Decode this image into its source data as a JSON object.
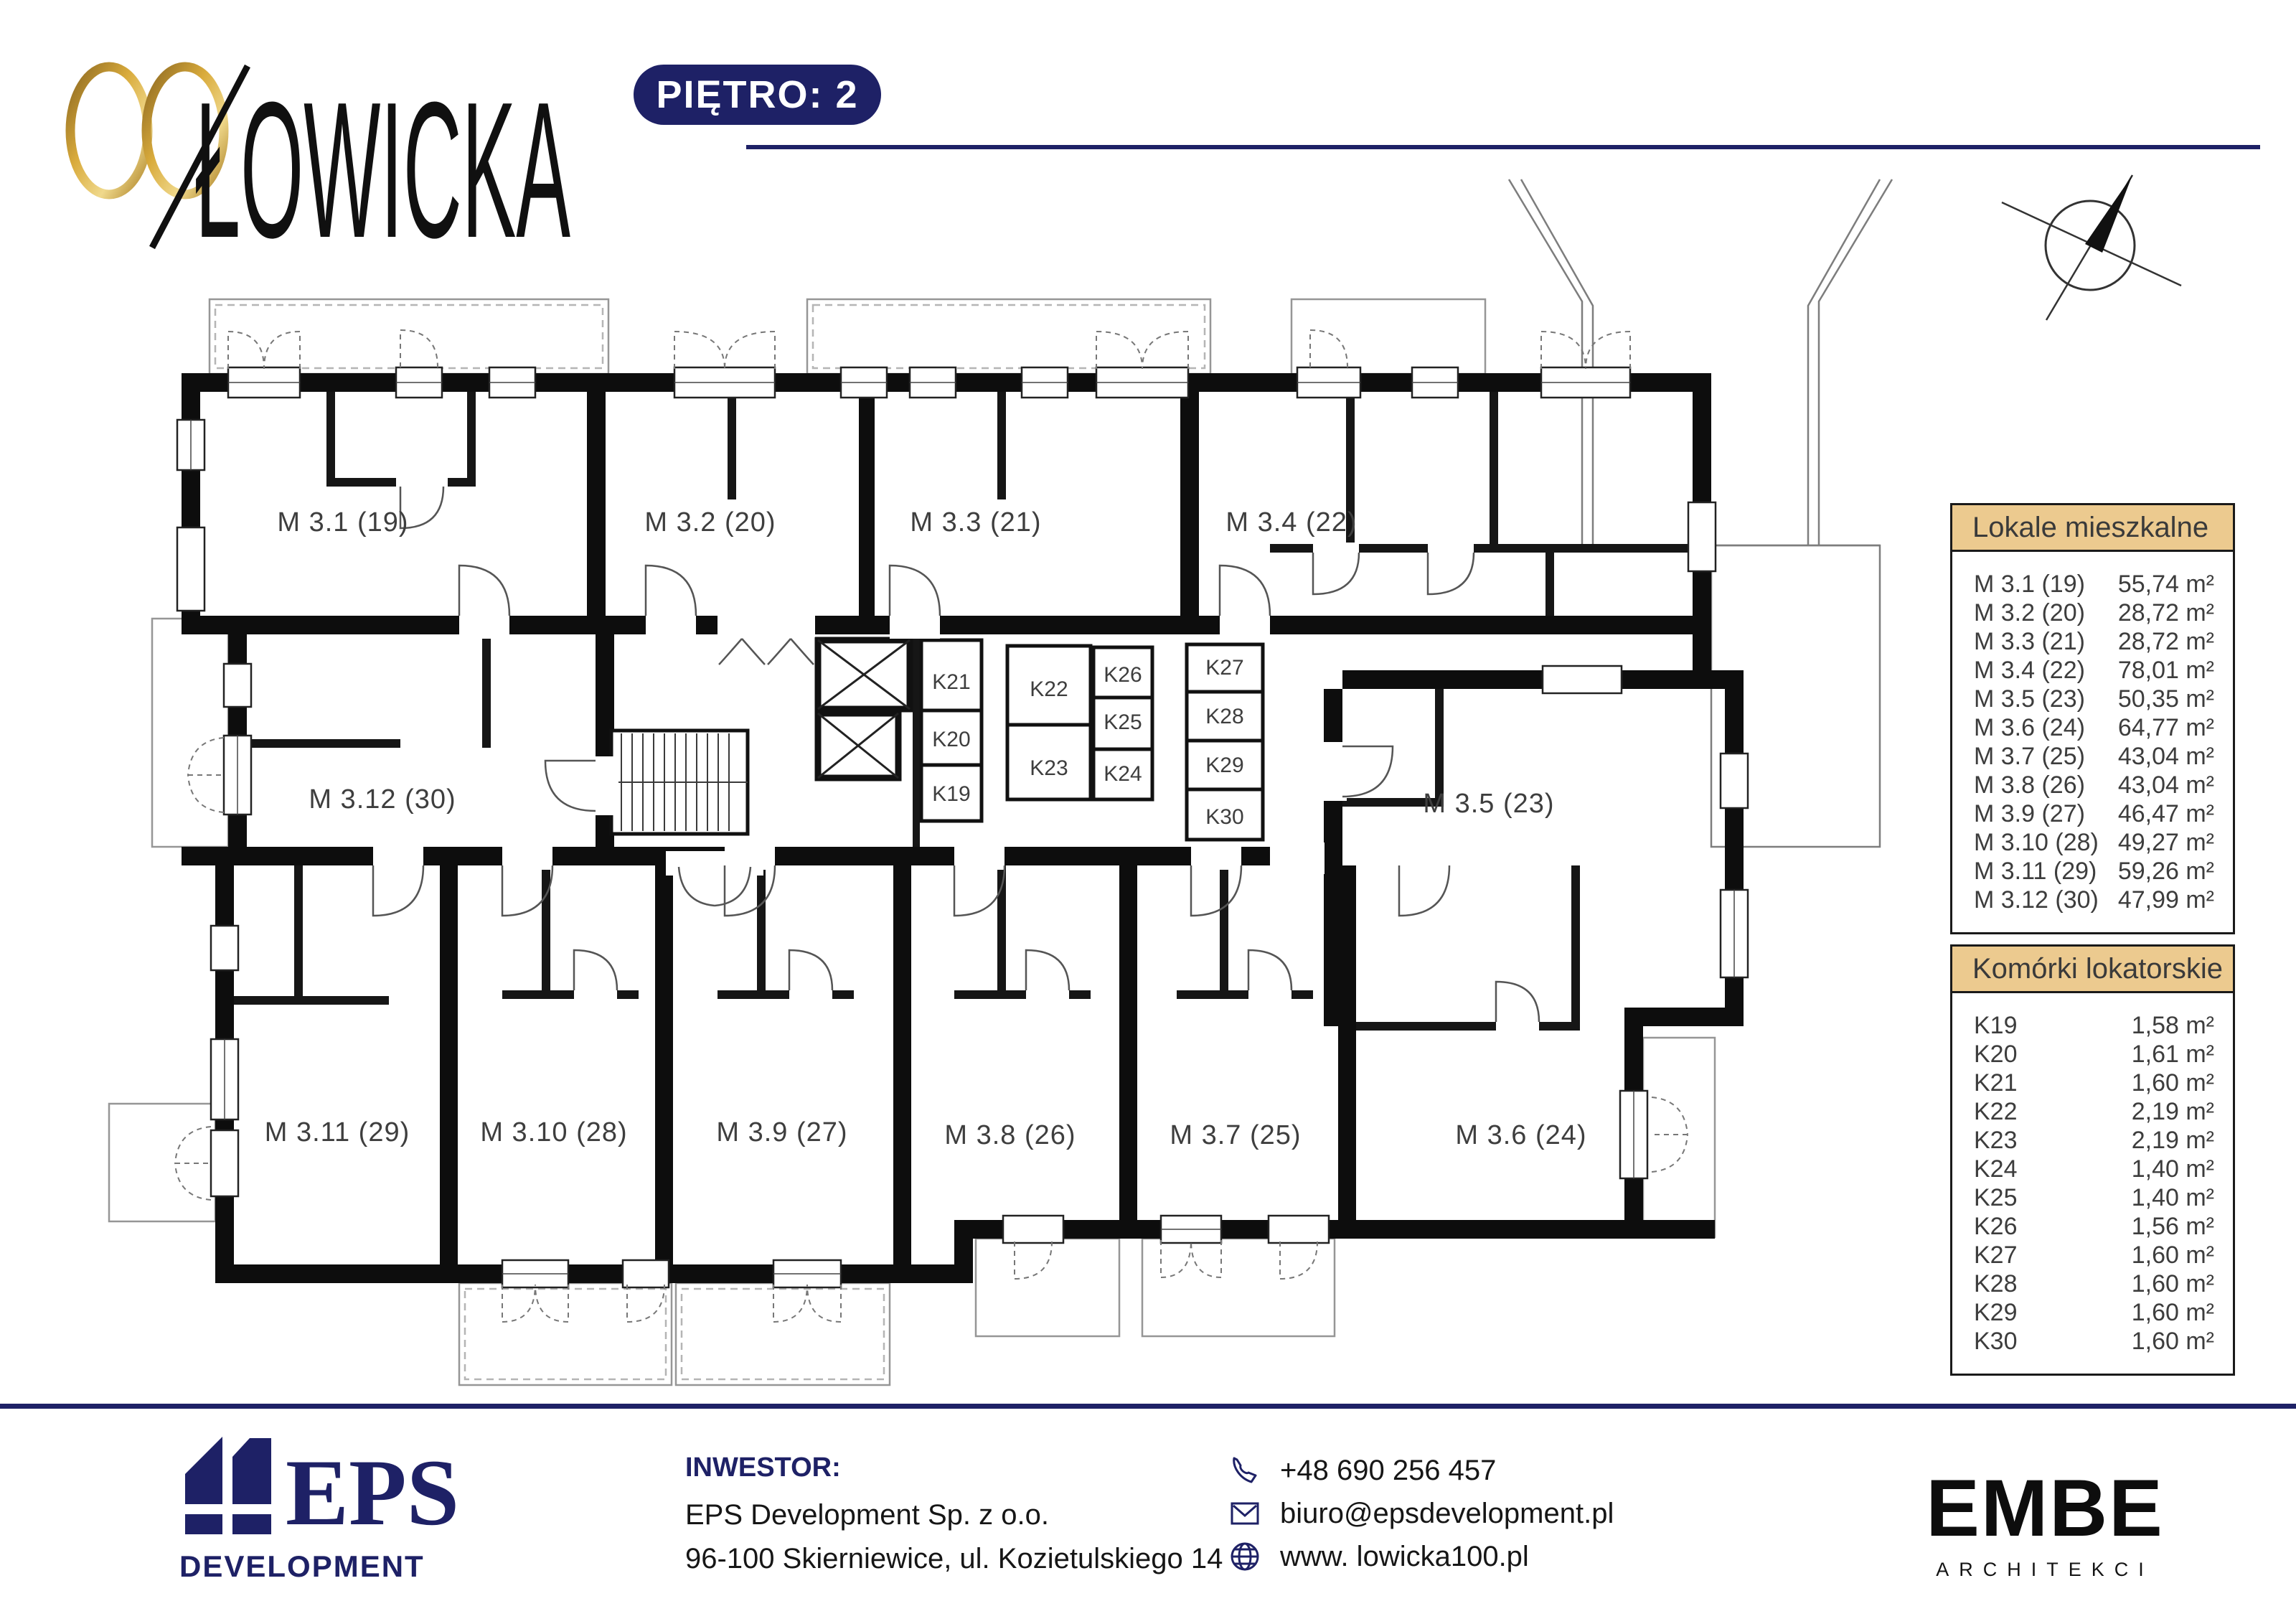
{
  "header": {
    "logo_number": "100",
    "logo_name": "ŁOWICKA",
    "floor_badge": "PIĘTRO: 2"
  },
  "legend_apartments": {
    "title": "Lokale mieszkalne",
    "rows": [
      {
        "label": "M 3.1 (19)",
        "area": "55,74 m²"
      },
      {
        "label": "M 3.2 (20)",
        "area": "28,72 m²"
      },
      {
        "label": "M 3.3 (21)",
        "area": "28,72 m²"
      },
      {
        "label": "M 3.4 (22)",
        "area": "78,01 m²"
      },
      {
        "label": "M 3.5 (23)",
        "area": "50,35 m²"
      },
      {
        "label": "M 3.6 (24)",
        "area": "64,77 m²"
      },
      {
        "label": "M 3.7 (25)",
        "area": "43,04 m²"
      },
      {
        "label": "M 3.8 (26)",
        "area": "43,04 m²"
      },
      {
        "label": "M 3.9 (27)",
        "area": "46,47 m²"
      },
      {
        "label": "M 3.10 (28)",
        "area": "49,27 m²"
      },
      {
        "label": "M 3.11 (29)",
        "area": "59,26 m²"
      },
      {
        "label": "M 3.12 (30)",
        "area": "47,99 m²"
      }
    ]
  },
  "legend_storage": {
    "title": "Komórki lokatorskie",
    "rows": [
      {
        "label": "K19",
        "area": "1,58 m²"
      },
      {
        "label": "K20",
        "area": "1,61 m²"
      },
      {
        "label": "K21",
        "area": "1,60 m²"
      },
      {
        "label": "K22",
        "area": "2,19 m²"
      },
      {
        "label": "K23",
        "area": "2,19 m²"
      },
      {
        "label": "K24",
        "area": "1,40 m²"
      },
      {
        "label": "K25",
        "area": "1,40 m²"
      },
      {
        "label": "K26",
        "area": "1,56 m²"
      },
      {
        "label": "K27",
        "area": "1,60 m²"
      },
      {
        "label": "K28",
        "area": "1,60 m²"
      },
      {
        "label": "K29",
        "area": "1,60 m²"
      },
      {
        "label": "K30",
        "area": "1,60 m²"
      }
    ]
  },
  "plan": {
    "apartments": [
      "M 3.1 (19)",
      "M 3.2 (20)",
      "M 3.3 (21)",
      "M 3.4 (22)",
      "M 3.5 (23)",
      "M 3.6 (24)",
      "M 3.7 (25)",
      "M 3.8 (26)",
      "M 3.9 (27)",
      "M 3.10 (28)",
      "M 3.11 (29)",
      "M 3.12 (30)"
    ],
    "storage": [
      "K19",
      "K20",
      "K21",
      "K22",
      "K23",
      "K24",
      "K25",
      "K26",
      "K27",
      "K28",
      "K29",
      "K30"
    ]
  },
  "footer": {
    "investor_label": "INWESTOR:",
    "investor_name": "EPS Development Sp. z o.o.",
    "investor_address": "96-100 Skierniewice, ul. Kozietulskiego 14",
    "phone": "+48 690 256 457",
    "email": "biuro@epsdevelopment.pl",
    "website": "www. lowicka100.pl",
    "eps_logo_name": "EPS",
    "eps_logo_sub": "DEVELOPMENT",
    "architect_logo_name": "EMBE",
    "architect_logo_sub": "ARCHITEKCI"
  },
  "colors": {
    "navy": "#1e2166",
    "gold_panel": "#ecca8f",
    "gold_logo": "#c79b3a"
  }
}
